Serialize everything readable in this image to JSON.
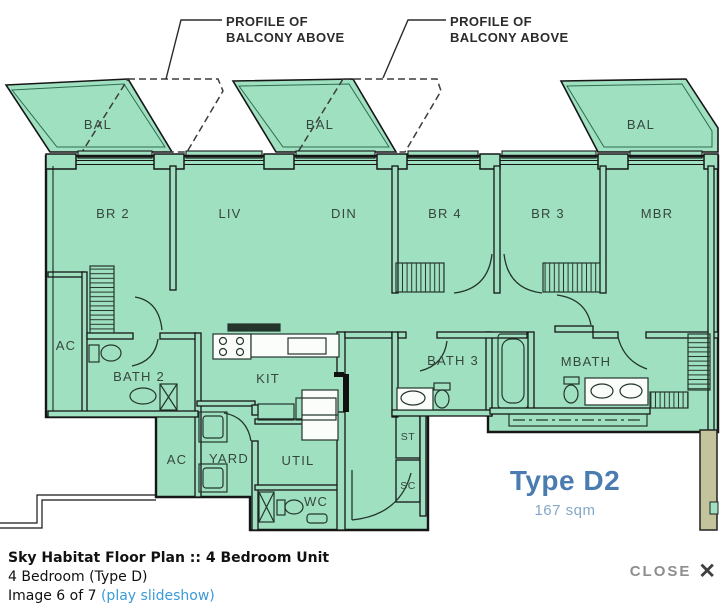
{
  "plan": {
    "callouts": {
      "line1": "PROFILE OF",
      "line2": "BALCONY ABOVE"
    },
    "rooms": {
      "bal1": "BAL",
      "bal2": "BAL",
      "bal3": "BAL",
      "br2": "BR 2",
      "liv": "LIV",
      "din": "DIN",
      "br4": "BR 4",
      "br3": "BR 3",
      "mbr": "MBR",
      "ac_upper": "AC",
      "bath2": "BATH 2",
      "kit": "KIT",
      "bath3": "BATH 3",
      "mbath": "MBATH",
      "ac_lower": "AC",
      "yard": "YARD",
      "util": "UTIL",
      "wc": "WC",
      "st": "ST",
      "sc": "SC"
    },
    "unit_type": {
      "code": "Type D2",
      "area": "167 sqm"
    },
    "colors": {
      "plan_fill": "#9fe0c1",
      "wall": "#161616",
      "type_blue": "#4b7cb1",
      "area_blue": "#85a8c8",
      "tan_strip": "#c3c49c"
    }
  },
  "caption": {
    "title": "Sky Habitat Floor Plan :: 4 Bedroom Unit",
    "subtitle": "4 Bedroom (Type D)",
    "position": "Image 6 of 7",
    "slideshow_link": "(play slideshow)"
  },
  "close": {
    "label": "CLOSE",
    "icon": "✕"
  }
}
